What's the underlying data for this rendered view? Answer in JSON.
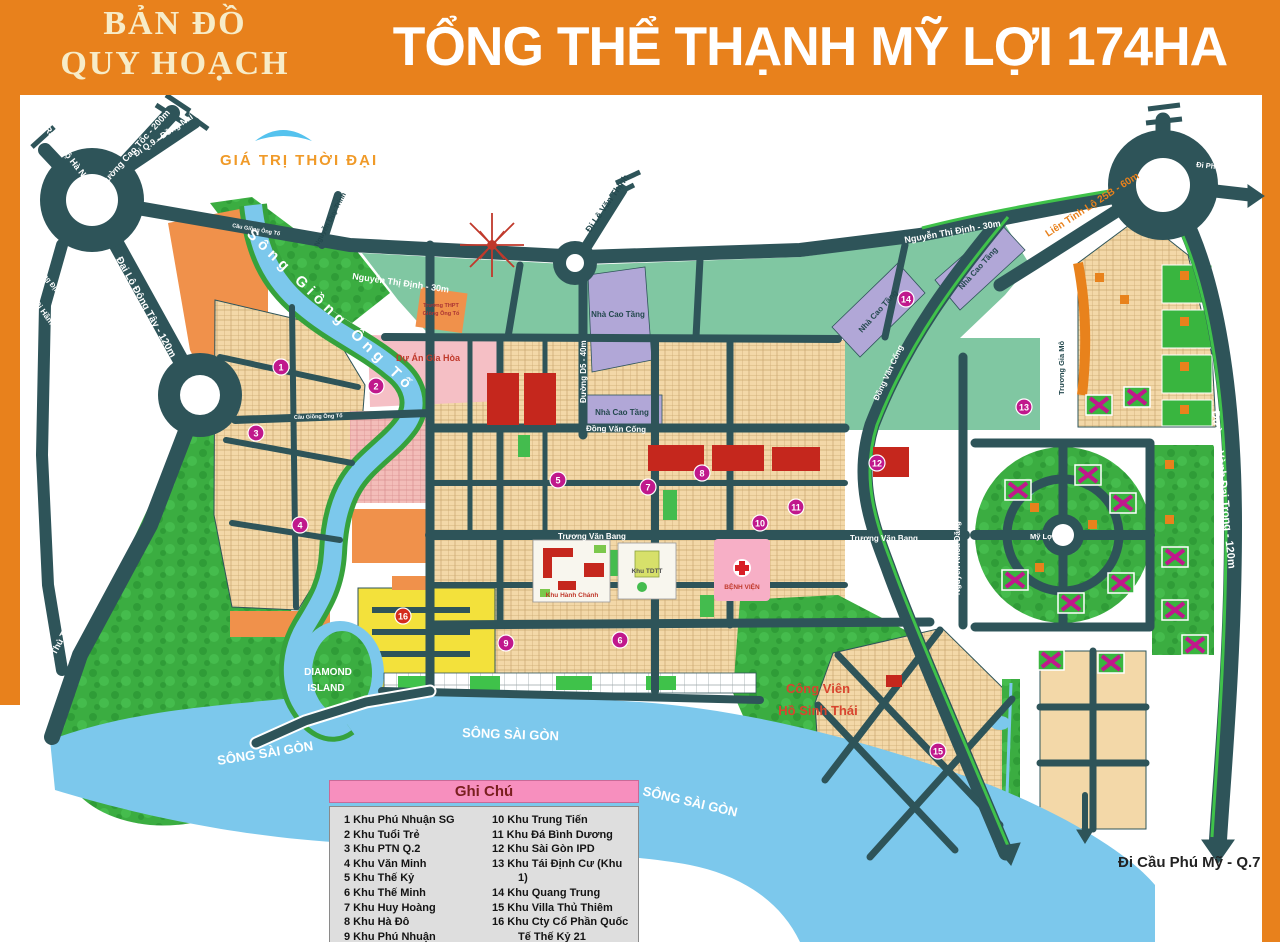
{
  "header": {
    "program_line1": "BẢN ĐỒ",
    "program_line2": "QUY HOẠCH",
    "title": "TỔNG THỂ THẠNH MỸ LỢI 174HA"
  },
  "logo": {
    "text": "GIÁ TRỊ THỜI ĐẠI"
  },
  "roads": {
    "ra_xa_lo_ha_noi": "Ra Xa Lộ Hà Nội",
    "duong_cao_toc": "Đường Cao Tốc - 200m",
    "di_q9_dong_nai": "Đi Q.9 - Đồng Nai",
    "luong_dinh_cua": "Lương Định Của (60m)",
    "di_ham_thu_thiem_q1": "Đi Hầm Thủ Thiêm - Q.1",
    "dai_lo_dong_tay": "Đại Lộ Đông Tây - 120m",
    "di_ham_thu_thiem": "Đi Hầm Thủ Thiêm",
    "nguyen_thi_dinh": "Nguyễn Thị Định - 30m",
    "nguyen_duy_trinh": "Nguyễn Duy Trinh",
    "di_le_van_thinh": "Đi Lê Văn Thịnh",
    "duong_d5": "Đường D5 - 40m",
    "lien_tinh_lo_25b": "Liên Tỉnh Lộ 25B - 60m",
    "di_pha_cat_lai": "Đi Phà Cát Lái",
    "duong_vanh_dai_trong": "Đường Vành Đai Trong - 120m",
    "truong_gia_mo": "Trương Gia Mô",
    "dong_van_cong": "Đồng Văn Cống",
    "truong_van_bang": "Trương Văn Bang",
    "nguyen_khoa_dang": "Nguyễn Khoa Đăng",
    "my_loi": "Mỹ Lợi",
    "di_cau_phu_my": "Đi Cầu Phú Mỹ - Q.7",
    "cau_giong_ong_to": "Cầu Giồng Ông Tố"
  },
  "areas": {
    "song_giong_ong_to": "Sông Giồng Ông Tố",
    "song_sai_gon": "SÔNG   SÀI   GÒN",
    "diamond_island_1": "DIAMOND",
    "diamond_island_2": "ISLAND",
    "cong_vien_1": "Công Viên",
    "cong_vien_2": "Hồ Sinh Thái",
    "nha_cao_tang": "Nhà Cao Tầng",
    "du_an_gia_hoa": "Dự Án Gia Hòa",
    "khu_hanh_chanh": "Khu Hành Chánh",
    "khu_tdtt": "Khu TDTT",
    "benh_vien": "BỆNH VIỆN",
    "truong_thpt_1": "Trường THPT",
    "truong_thpt_2": "Giồng Ông Tố"
  },
  "legend": {
    "title": "Ghi Chú",
    "items_left": [
      "1 Khu Phú Nhuận SG",
      "2 Khu Tuổi Trẻ",
      "3 Khu PTN Q.2",
      "4 Khu Văn Minh",
      "5 Khu Thế Kỷ",
      "6 Khu Thế Minh",
      "7 Khu Huy Hoàng",
      "8 Khu Hà Đô",
      "9 Khu Phú Nhuận"
    ],
    "items_right": [
      "10 Khu Trung Tiến",
      "11 Khu Đá Bình Dương",
      "12 Khu Sài Gòn IPD",
      "13 Khu Tái Định Cư (Khu 1)",
      "14 Khu Quang Trung",
      "15 Khu Villa Thủ Thiêm",
      "16 Khu Cty Cổ Phần Quốc Tế Thế Kỷ 21"
    ]
  },
  "markers": [
    {
      "n": "1",
      "x": 281,
      "y": 272
    },
    {
      "n": "2",
      "x": 376,
      "y": 291
    },
    {
      "n": "3",
      "x": 256,
      "y": 338
    },
    {
      "n": "4",
      "x": 300,
      "y": 430
    },
    {
      "n": "5",
      "x": 558,
      "y": 385
    },
    {
      "n": "6",
      "x": 620,
      "y": 545
    },
    {
      "n": "7",
      "x": 648,
      "y": 392
    },
    {
      "n": "8",
      "x": 702,
      "y": 378
    },
    {
      "n": "9",
      "x": 506,
      "y": 548
    },
    {
      "n": "10",
      "x": 760,
      "y": 428
    },
    {
      "n": "11",
      "x": 796,
      "y": 412
    },
    {
      "n": "12",
      "x": 877,
      "y": 368
    },
    {
      "n": "13",
      "x": 1024,
      "y": 312
    },
    {
      "n": "14",
      "x": 906,
      "y": 204
    },
    {
      "n": "15",
      "x": 938,
      "y": 656
    },
    {
      "n": "16",
      "x": 403,
      "y": 521,
      "color": "#D42B1E"
    }
  ],
  "colors": {
    "header_orange": "#E8811C",
    "road_teal": "#2E5459",
    "river_blue": "#7CC8EC",
    "park_green": "#3BAD41",
    "median_green": "#3FC24A",
    "seagreen_zone": "#80C7A2",
    "tan_lots": "#F3D8A8",
    "pink_zone": "#F5BFC5",
    "purple_zone": "#B1A7D7",
    "yellow_zone": "#F3E13B",
    "red_building": "#C5271D",
    "marker_magenta": "#C0188C",
    "legend_pink": "#F78FBE"
  }
}
